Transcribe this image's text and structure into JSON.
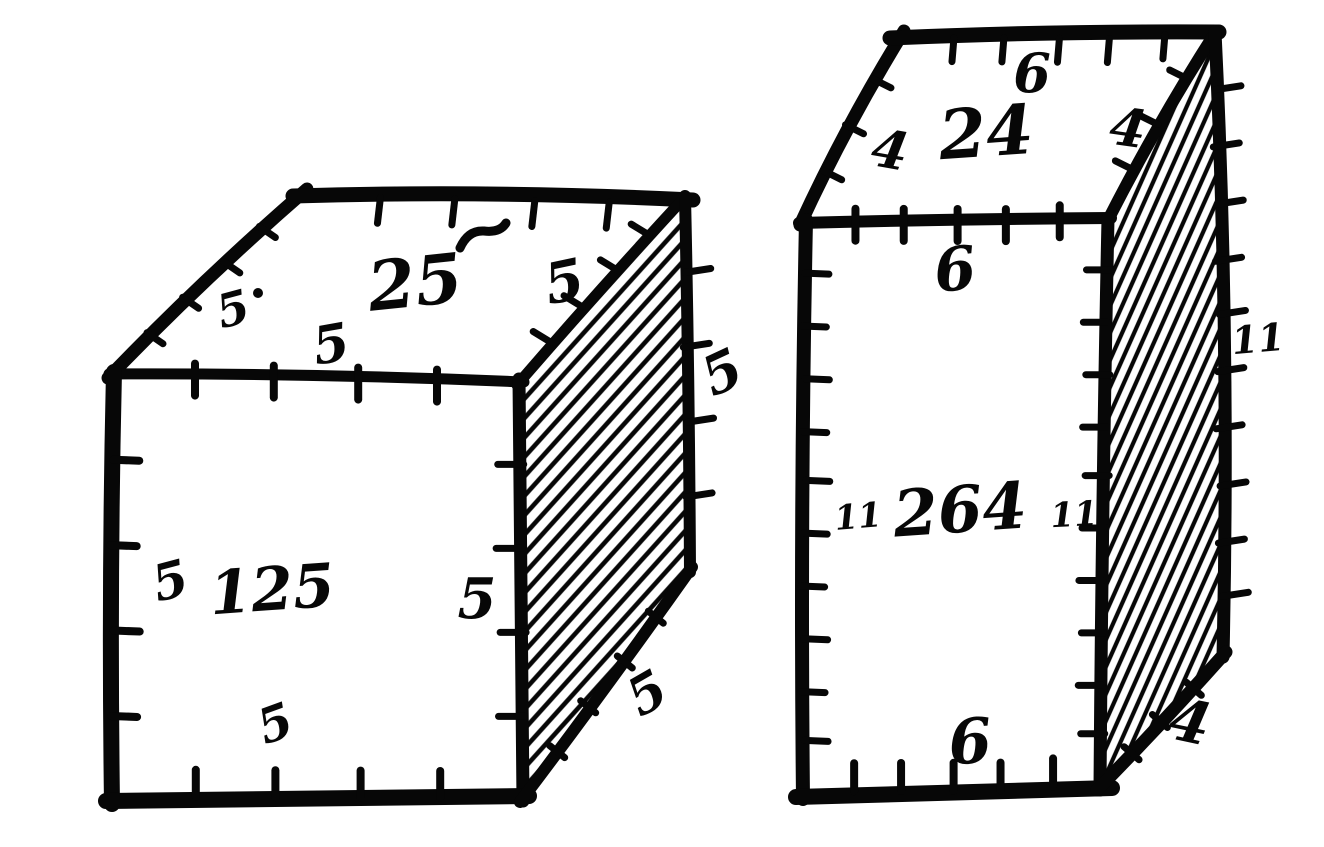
{
  "figure": {
    "kind": "woodcut-arithmetic-diagram",
    "paper_color": "#ffffff",
    "ink_color": "#070707",
    "boxes": [
      {
        "id": "cube-125",
        "units": {
          "width": 5,
          "depth": 5,
          "height": 5
        },
        "labels": {
          "top_depth_left": "5",
          "top_face_area": "25",
          "top_depth_right": "5",
          "top_width": "5",
          "depth_outer_right": "5",
          "front_height_left": "5",
          "front_volume": "125",
          "front_height_right": "5",
          "front_width_bottom": "5",
          "bottom_depth_slant": "5"
        }
      },
      {
        "id": "box-264",
        "units": {
          "width": 6,
          "depth": 4,
          "height": 11
        },
        "labels": {
          "top_width_back": "6",
          "top_face_area": "24",
          "top_depth_left": "4",
          "top_depth_right": "4",
          "front_width_top": "6",
          "front_height_left": "11",
          "front_volume": "264",
          "front_height_right": "11",
          "front_width_bottom": "6",
          "height_outer_right": "11",
          "bottom_depth_slant": "4"
        }
      }
    ]
  }
}
